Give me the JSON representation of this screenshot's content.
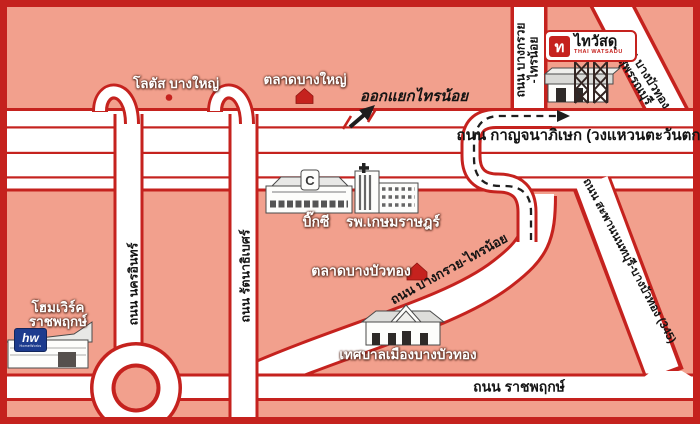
{
  "map_title": "Thai Watsadu Bang Bua Thong location map",
  "colors": {
    "background_pink": "#f2a08d",
    "road_red": "#c5221e",
    "road_white": "#ffffff",
    "text_black": "#141414",
    "homework_blue": "#1d3b8e"
  },
  "roads": {
    "kanchanaphisek": "ถนน กาญจนาภิเษก (วงแหวนตะวันตก)",
    "ratchaphruek": "ถนน ราชพฤกษ์",
    "nakhon_in": "ถนน นครอินทร์",
    "rattanathibet": "ถนน รัตนาธิเบศร์",
    "bangkruai_sainoi_vertical_line1": "ถนน บางกรวย",
    "bangkruai_sainoi_vertical_line2": "-ไทรน้อย",
    "bangkruai_sainoi_diagonal": "ถนน บางกรวย-ไทรน้อย",
    "saphan_nonthaburi": "ถนน สะพานนนทบุรี-บางบัวทอง (345)",
    "bangbuathong_suphanburi_line1": "ถนน บางบัวทอง",
    "bangbuathong_suphanburi_line2": "-สุพรรณบุรี"
  },
  "landmarks": {
    "lotus_bangyai": "โลตัส บางใหญ่",
    "bangyai_market": "ตลาดบางใหญ่",
    "exit_sainoi": "ออกแยกไทรน้อย",
    "bigc": "บิ๊กซี",
    "bigc_logo_letter": "C",
    "kasemrad_hospital": "รพ.เกษมราษฎร์",
    "bangbuathong_market": "ตลาดบางบัวทอง",
    "municipality": "เทศบาลเมืองบางบัวทอง",
    "homework_line1": "โฮมเวิร์ค",
    "homework_line2": "ราชพฤกษ์",
    "homework_logo": "hw",
    "homework_logo_sub": "HomeWorks",
    "thaiwatsadu_glyph": "ท",
    "thaiwatsadu_thai": "ไทวัสดุ",
    "thaiwatsadu_latin": "THAI WATSADU"
  },
  "icons": {
    "route_markers": [
      "red-house-marker-bangyai-market",
      "red-house-marker-bangbuathong-market",
      "red-dot-marker-lotus"
    ],
    "route_line": "dashed-route-with-arrow",
    "exit_symbol": "black-arrow-with-red-slashes"
  }
}
